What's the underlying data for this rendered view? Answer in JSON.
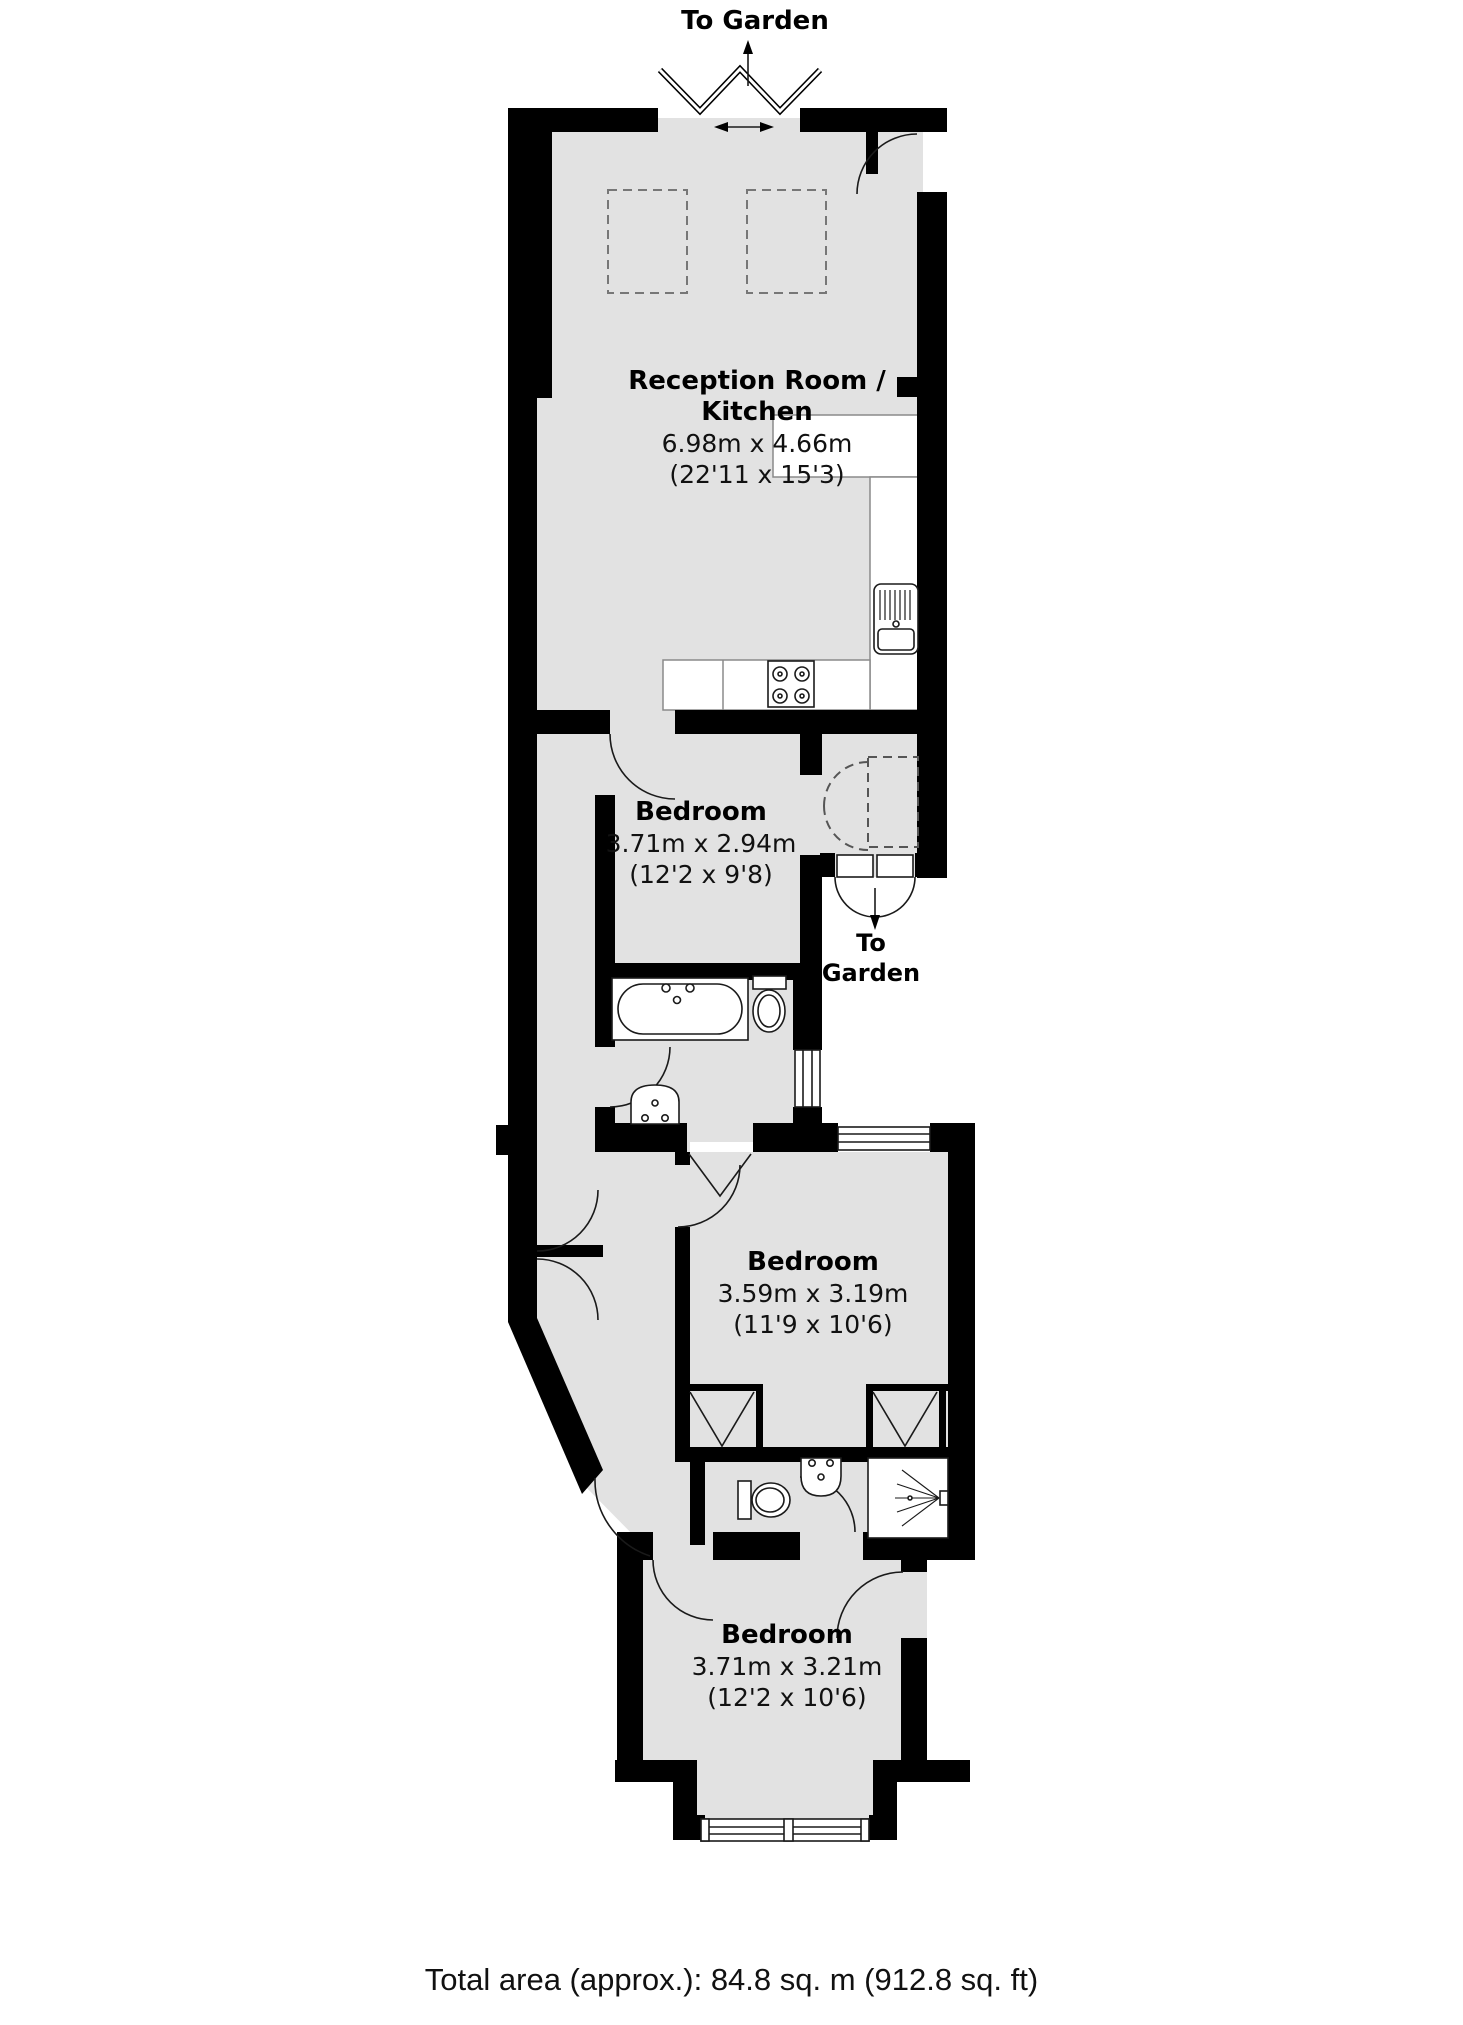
{
  "garden_top": {
    "label": "To Garden"
  },
  "garden_mid": {
    "line1": "To",
    "line2": "Garden"
  },
  "rooms": {
    "reception": {
      "name_line1": "Reception Room /",
      "name_line2": "Kitchen",
      "metric": "6.98m x 4.66m",
      "imperial": "(22'11 x 15'3)"
    },
    "bedroom1": {
      "name": "Bedroom",
      "metric": "3.71m x 2.94m",
      "imperial": "(12'2 x 9'8)"
    },
    "bedroom2": {
      "name": "Bedroom",
      "metric": "3.59m x 3.19m",
      "imperial": "(11'9 x 10'6)"
    },
    "bedroom3": {
      "name": "Bedroom",
      "metric": "3.71m x 3.21m",
      "imperial": "(12'2 x 10'6)"
    }
  },
  "footer": {
    "total_area": "Total area (approx.): 84.8 sq. m (912.8 sq. ft)"
  },
  "colors": {
    "wall": "#000000",
    "floor": "#e2e2e2",
    "background": "#ffffff",
    "fixture_stroke": "#1a1a1a"
  }
}
